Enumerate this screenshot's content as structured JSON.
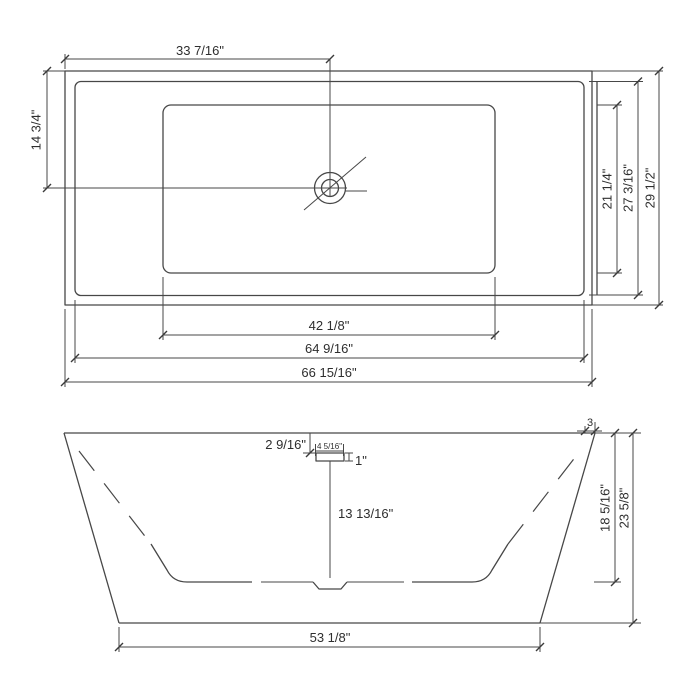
{
  "title": "Bathtub dimension drawing",
  "colors": {
    "line": "#474747",
    "text": "#2e2e2e",
    "background": "#ffffff"
  },
  "top_view": {
    "name": "plan-view",
    "labels": {
      "drain_from_left": "33 7/16\"",
      "drain_from_top": "14 3/4\"",
      "basin_length": "42 1/8\"",
      "inner_length": "64 9/16\"",
      "overall_length": "66 15/16\"",
      "basin_width": "21 1/4\"",
      "inner_width": "27 3/16\"",
      "overall_width": "29 1/2\""
    }
  },
  "front_view": {
    "name": "front-elevation",
    "labels": {
      "overflow_from_rim": "2 9/16\"",
      "drain_fitting_width": "4 5/16\"",
      "drain_fitting_height": "1\"",
      "drain_to_floor": "13 13/16\"",
      "rim_lip": "3",
      "inner_depth": "18 5/16\"",
      "overall_height": "23 5/8\"",
      "base_length": "53 1/8\""
    }
  }
}
